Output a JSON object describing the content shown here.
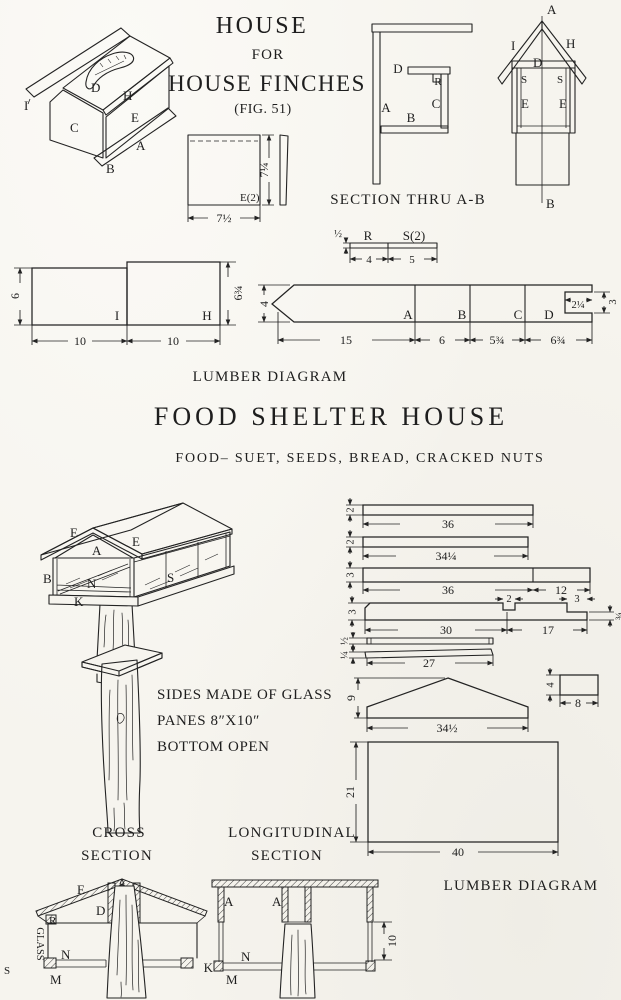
{
  "palette": {
    "paper": "#f6f4ee",
    "ink": "#232323"
  },
  "header": {
    "title_line1": "HOUSE",
    "title_line2": "FOR",
    "title_line3": "HOUSE FINCHES",
    "fig_caption": "(FIG. 51)"
  },
  "captions": {
    "section_thru": "SECTION THRU A-B",
    "lumber_top": "LUMBER DIAGRAM",
    "food_title": "FOOD  SHELTER  HOUSE",
    "food_note": "FOOD– SUET, SEEDS, BREAD, CRACKED NUTS",
    "glass1": "SIDES MADE OF GLASS",
    "glass2": "PANES 8″X10″",
    "glass3": "BOTTOM OPEN",
    "cross1": "CROSS",
    "cross2": "SECTION",
    "long1": "LONGITUDINAL",
    "long2": "SECTION",
    "lumber_bottom": "LUMBER DIAGRAM"
  },
  "iso_house": {
    "I": "I",
    "D": "D",
    "H": "H",
    "C": "C",
    "E": "E",
    "B": "B",
    "A": "A"
  },
  "section_view": {
    "D": "D",
    "R": "R",
    "A": "A",
    "C": "C",
    "B": "B"
  },
  "front_view": {
    "A": "A",
    "I": "I",
    "H": "H",
    "D": "D",
    "S1": "S",
    "S2": "S",
    "E1": "E",
    "E2": "E",
    "B": "B"
  },
  "lumber1": {
    "h1": "6",
    "h2": "6¾",
    "w1": "10",
    "w2": "10",
    "p1": "I",
    "p2": "H",
    "sq_h": "7¼",
    "sq_w": "7½",
    "sq_part": "E(2)"
  },
  "lumber2": {
    "thick": "½",
    "partR": "R",
    "partS": "S(2)",
    "w4": "4",
    "w5": "5",
    "height": "4",
    "A": "A",
    "B": "B",
    "C": "C",
    "D": "D",
    "wA": "15",
    "wB": "6",
    "wC": "5¾",
    "wD": "6¾",
    "notch_w": "2¼",
    "notch_h": "3"
  },
  "food_iso": {
    "E1": "E",
    "E2": "E",
    "A": "A",
    "B": "B",
    "N": "N",
    "K": "K",
    "S": "S"
  },
  "boards": {
    "b1": {
      "t": "2",
      "w": "36"
    },
    "b2": {
      "t": "2",
      "w": "34¼"
    },
    "b3": {
      "t": "3",
      "w": "36",
      "w2": "12"
    },
    "b4": {
      "t": "3",
      "n1": "2",
      "n2": "3",
      "w": "30",
      "w2": "17",
      "end": "¾"
    },
    "b5": {
      "t": "½"
    },
    "b6": {
      "t": "¼",
      "w": "27"
    }
  },
  "gable": {
    "h": "9",
    "w": "34½"
  },
  "block": {
    "h": "4",
    "w": "8"
  },
  "panel": {
    "h": "21",
    "w": "40"
  },
  "cross_section": {
    "E": "E",
    "D": "D",
    "R": "R",
    "GLASS": "GLASS",
    "S": "S",
    "N": "N",
    "M": "M"
  },
  "long_section": {
    "A1": "A",
    "A2": "A",
    "K": "K",
    "M": "M",
    "N": "N",
    "dim": "10"
  }
}
